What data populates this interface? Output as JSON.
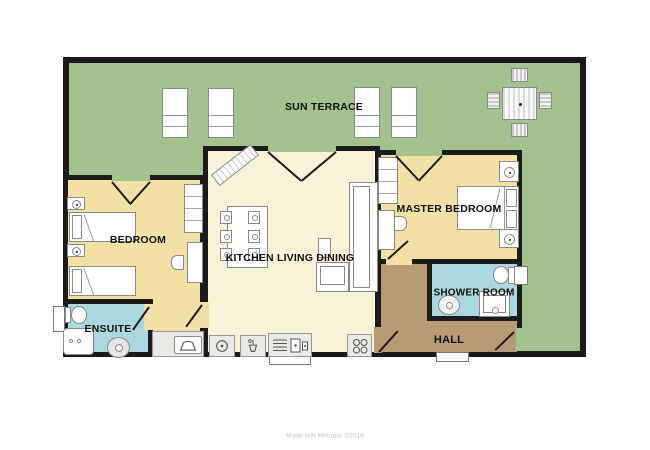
{
  "plan": {
    "footer_credit": "Made with Metropix ©2016",
    "wall_color": "#1b1b1b",
    "rooms": {
      "sun_terrace": {
        "label": "SUN TERRACE",
        "color": "#a3c28e"
      },
      "bedroom": {
        "label": "BEDROOM",
        "color": "#f2e0a4"
      },
      "kitchen_living_dining": {
        "label": "KITCHEN LIVING DINING",
        "color": "#f8f2d9"
      },
      "master_bedroom": {
        "label": "MASTER BEDROOM",
        "color": "#f2e0a4"
      },
      "ensuite": {
        "label": "ENSUITE",
        "color": "#abd7de"
      },
      "shower_room": {
        "label": "SHOWER ROOM",
        "color": "#abd7de"
      },
      "hall": {
        "label": "HALL",
        "color": "#b79b74"
      }
    },
    "colors": {
      "counter_gray": "#e9e9e5",
      "furniture_outline": "#8a8a8a",
      "credit_text": "#c4c4c4"
    },
    "furniture_icons": [
      "sun-lounger-icon",
      "patio-table-icon",
      "patio-chair-icon",
      "single-bed-icon",
      "double-bed-icon",
      "nightstand-lamp-icon",
      "dresser-icon",
      "desk-icon",
      "desk-chair-icon",
      "dining-table-icon",
      "dining-chair-icon",
      "corner-sofa-icon",
      "washing-machine-icon",
      "kitchen-sink-icon",
      "drainer-unit-icon",
      "hob-icon",
      "toilet-icon",
      "shower-tray-icon",
      "shower-drain-icon",
      "basin-icon",
      "vanity-icon",
      "storage-bench-icon",
      "sideboard-icon"
    ]
  }
}
